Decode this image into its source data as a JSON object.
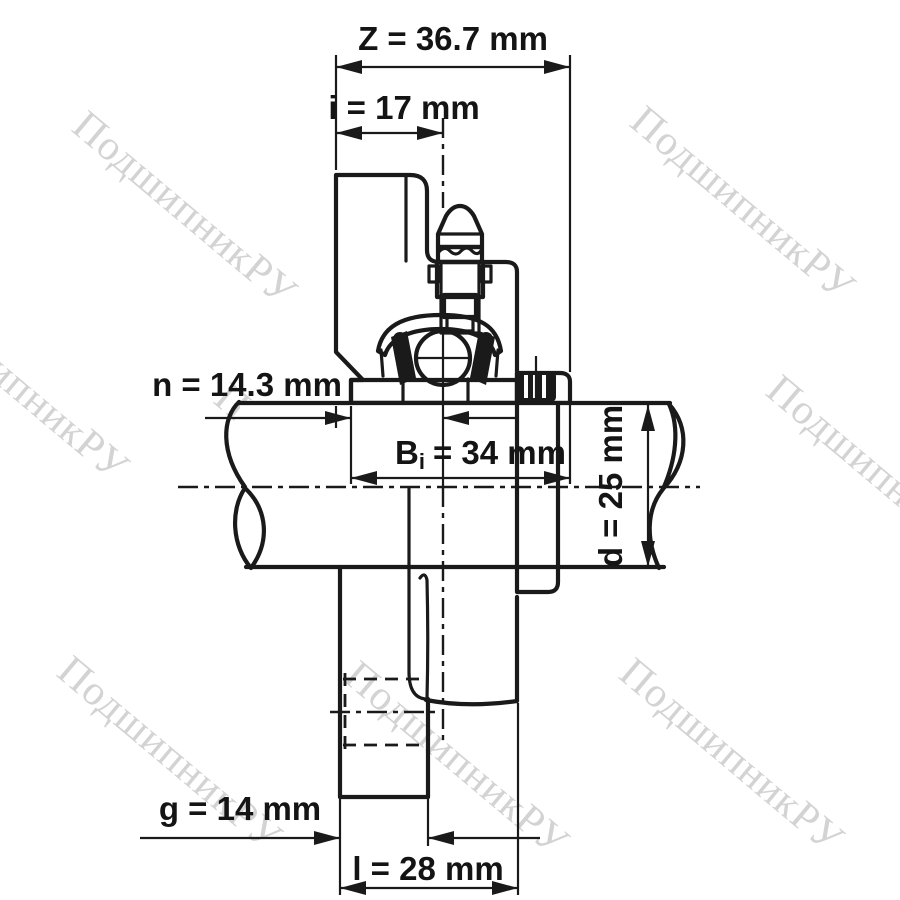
{
  "page": {
    "background": "#ffffff"
  },
  "watermark": {
    "text": "ПодшипникРУ",
    "color": "#cccccc"
  },
  "drawing": {
    "subject": "flanged-bearing-unit-cross-section",
    "colors": {
      "outline": "#1a1a1a",
      "housing_fill": "#e2e2e2",
      "break_fill": "#dadada"
    }
  },
  "dimensions": {
    "Z": {
      "label": "Z = 36.7 mm"
    },
    "i": {
      "label": "i = 17 mm"
    },
    "n": {
      "label": "n = 14.3 mm"
    },
    "Bi": {
      "prefix": "B",
      "sub": "i",
      "rest": "= 34 mm"
    },
    "d": {
      "label": "d = 25 mm"
    },
    "g": {
      "label": "g = 14 mm"
    },
    "l": {
      "label": "l = 28 mm"
    }
  }
}
